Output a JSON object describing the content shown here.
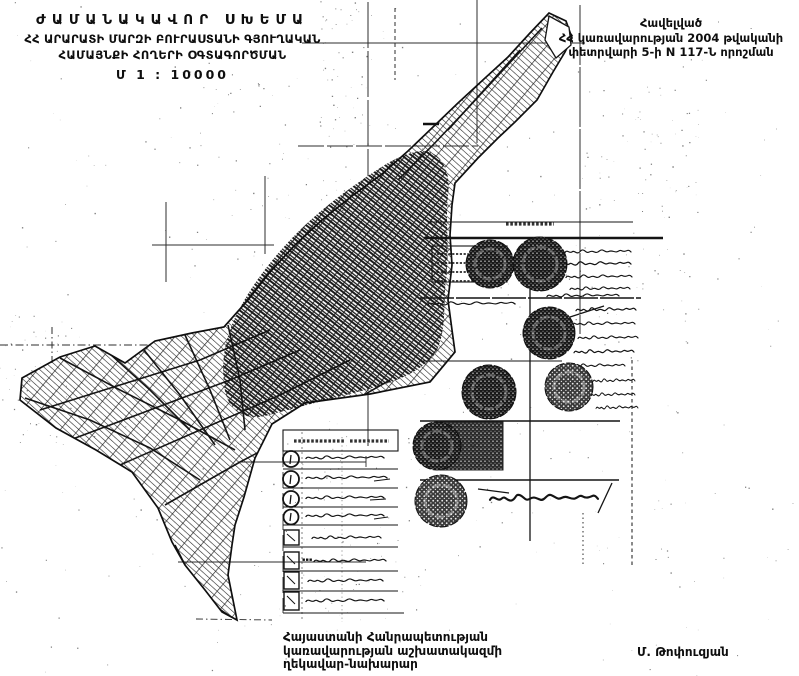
{
  "document": {
    "kind": "scanned temporary land-use scheme map",
    "language": "Armenian"
  },
  "colors": {
    "paper": "#ffffff",
    "ink": "#101010"
  },
  "title_block": {
    "line1": "ԺԱՄԱՆԱԿԱՎՈՐ  ՍԽԵՄԱ",
    "line2": "ՀՀ ԱՐԱՐԱՏԻ ՄԱՐԶԻ ԲՈՒՐԱՍՏԱՆԻ ԳՅՈՒՂԱԿԱՆ",
    "line3": "ՀԱՄԱՅՆՔԻ ՀՈՂԵՐԻ ՕԳՏԱԳՈՐԾՄԱՆ",
    "scale": "Մ 1 : 10000"
  },
  "approval_block": {
    "line1": "Հավելված",
    "line2": "ՀՀ կառավարության 2004 թվականի",
    "line3": "փետրվարի 5-ի N 117-Ն որոշման"
  },
  "footer": {
    "official_lines": [
      "Հայաստանի Հանրապետության",
      "կառավարության աշխատակազմի",
      "ղեկավար-նախարար"
    ],
    "signature": "Մ. Թոփուզյան"
  },
  "legend": {
    "note": "handwritten entries illegible in scan",
    "row_symbols": [
      "header-box",
      "numbered-circle",
      "numbered-circle",
      "numbered-circle",
      "numbered-circle",
      "square",
      "square",
      "square",
      "square"
    ]
  },
  "stamps": {
    "official_seal_icon": "dark-round-stamp",
    "count": 7
  }
}
